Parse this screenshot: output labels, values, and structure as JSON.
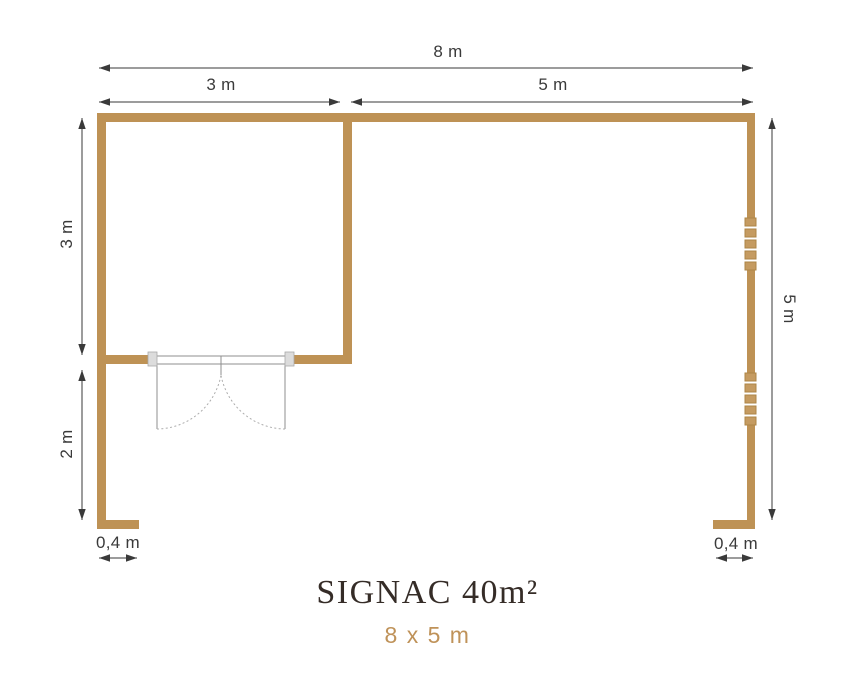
{
  "plan": {
    "title": "SIGNAC 40m²",
    "subtitle": "8 x 5 m",
    "dimensions": {
      "total_width": "8 m",
      "cabin_width": "3 m",
      "terrace_width": "5 m",
      "cabin_depth": "3 m",
      "terrace_depth": "2 m",
      "total_depth": "5 m",
      "stub_left": "0,4 m",
      "stub_right": "0,4 m"
    },
    "colors": {
      "wall": "#BE9255",
      "window_fill": "#C59B61",
      "window_stroke": "#AD8546",
      "dimension": "#3A3A3A",
      "title": "#352C27",
      "subtitle": "#BF9259",
      "door_jamb_fill": "#DCDCDC",
      "door_jamb_stroke": "#A9A9A9",
      "door_line": "#8F8F8F",
      "door_arc": "#ADADAD"
    }
  }
}
